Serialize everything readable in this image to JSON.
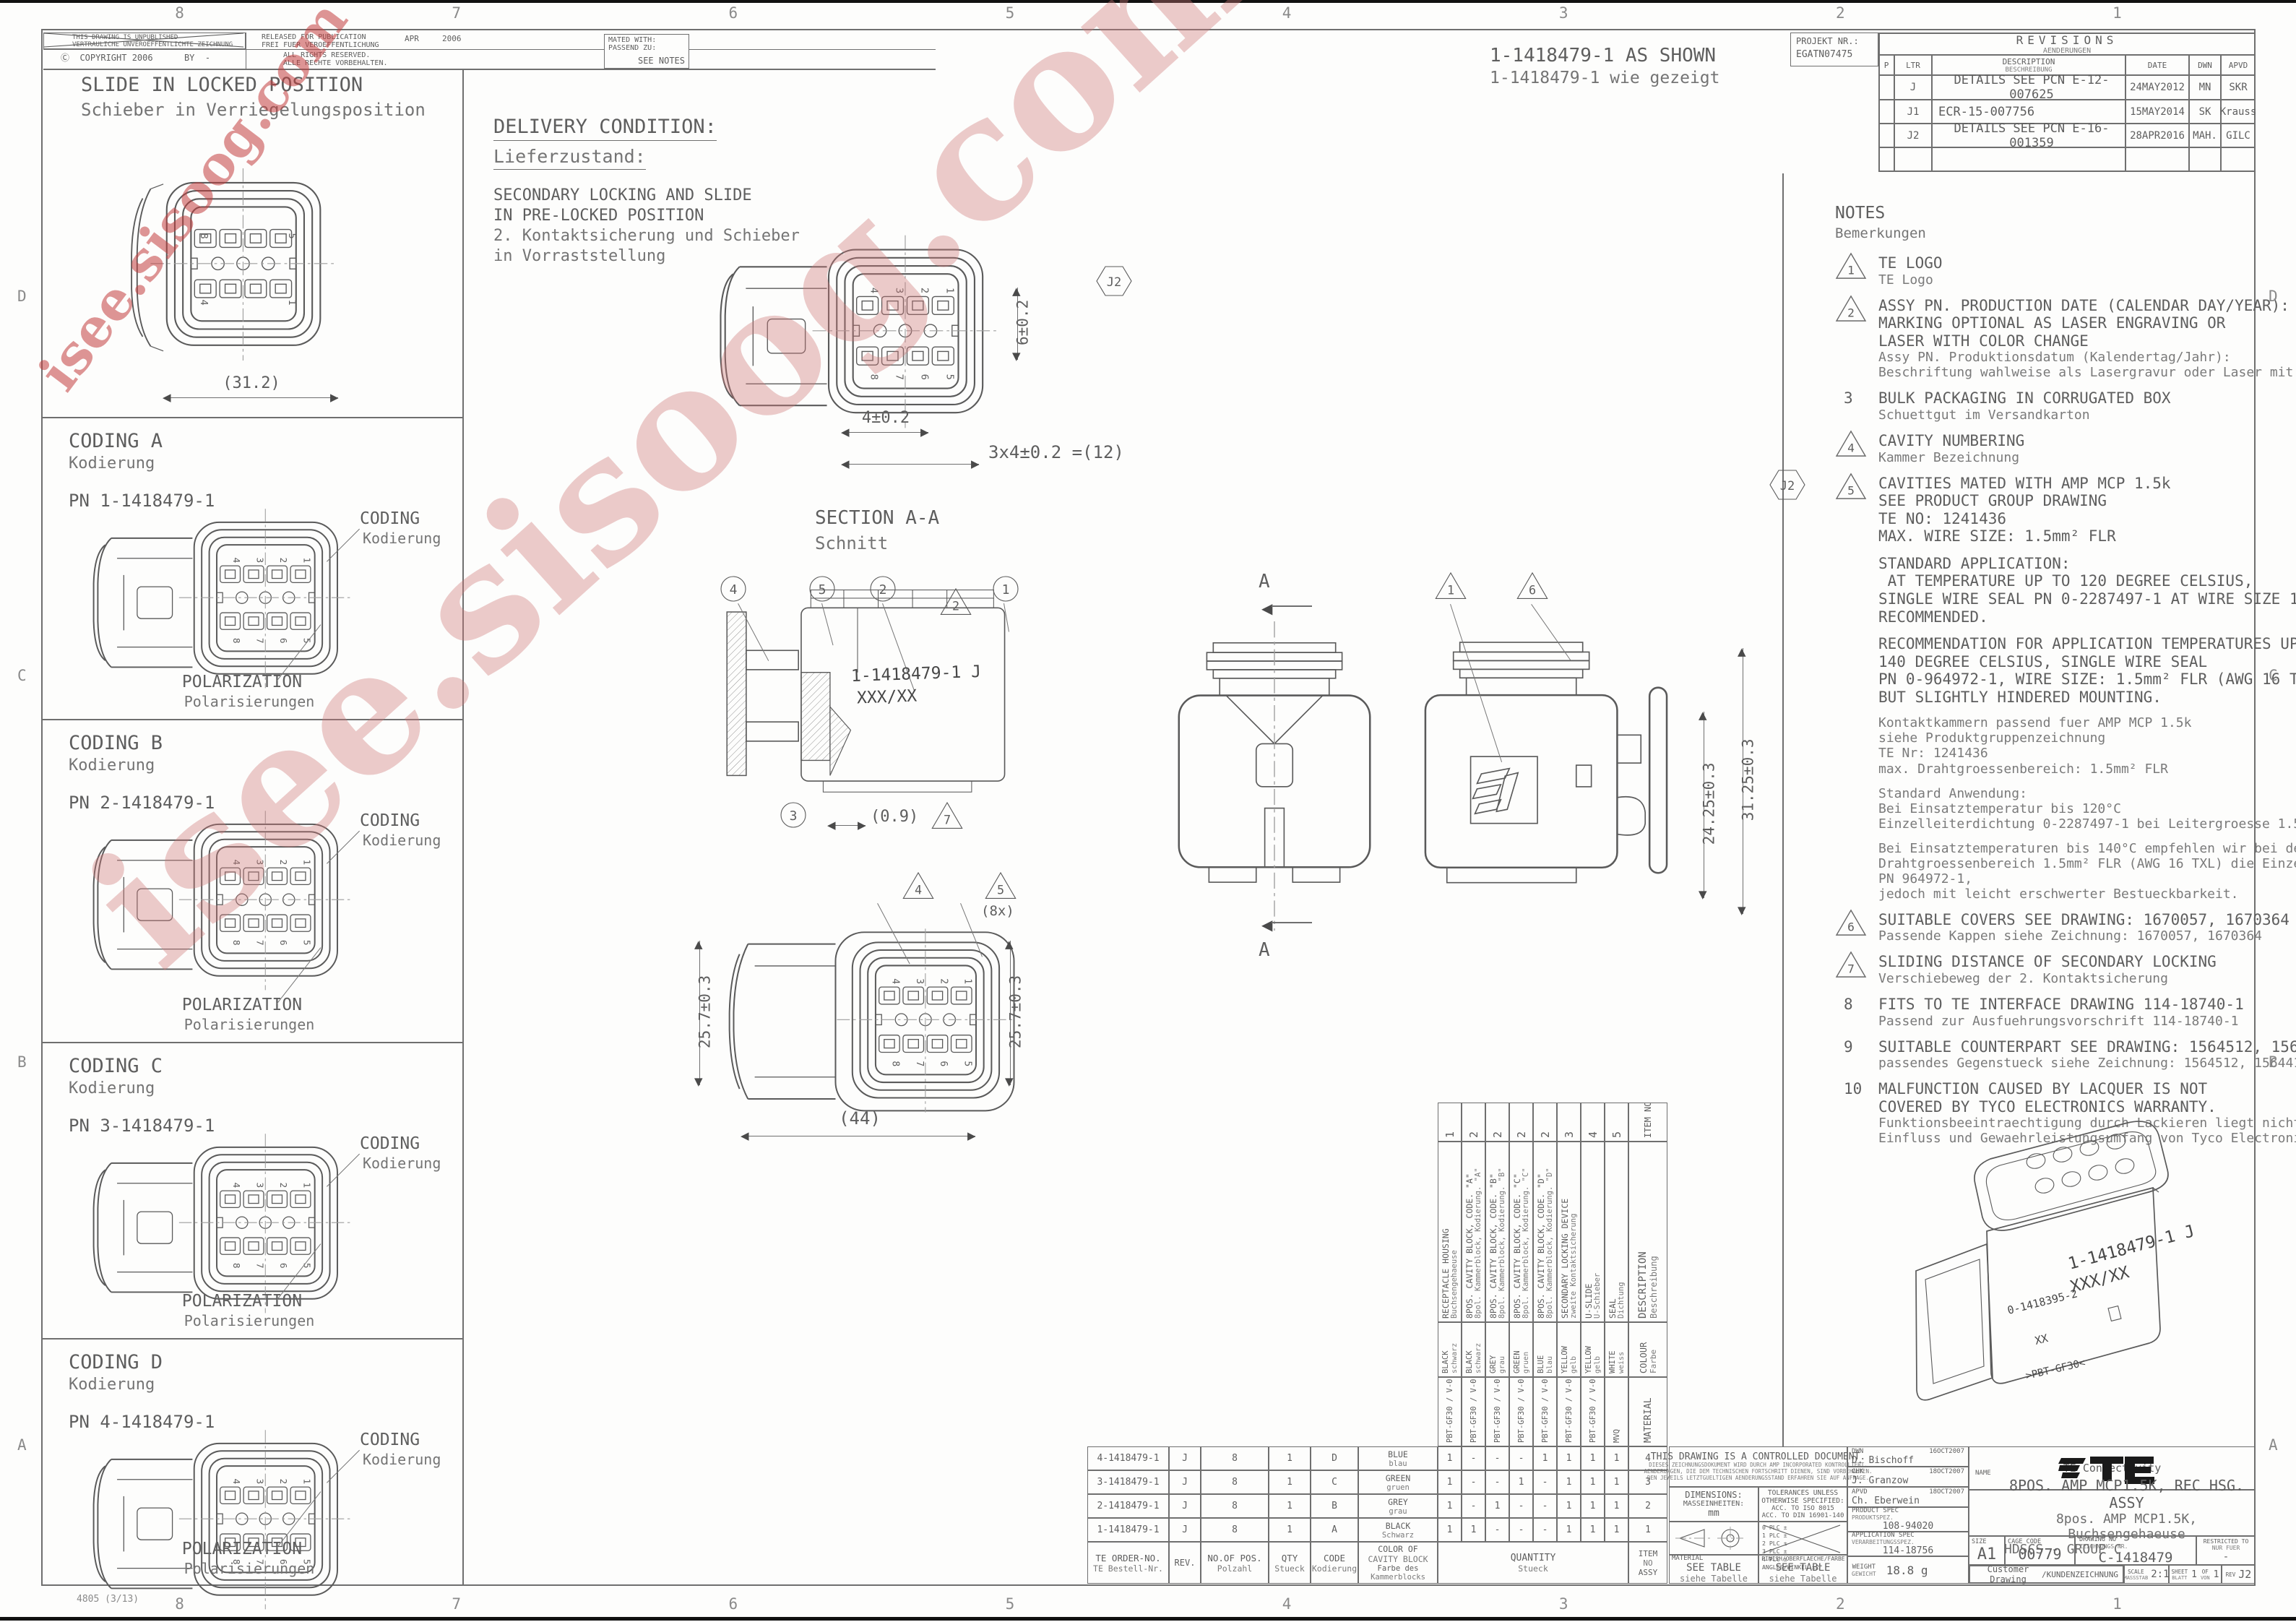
{
  "meta": {
    "accent": "#c75252",
    "line": "#5a5a5a"
  },
  "watermark": {
    "text": "isee.sisoog.com"
  },
  "frame": {
    "zones_h": [
      "8",
      "7",
      "6",
      "5",
      "4",
      "3",
      "2",
      "1"
    ],
    "zones_v": [
      "D",
      "C",
      "B",
      "A"
    ],
    "stamp": "4805 (3/13)"
  },
  "header": {
    "unpublished1": "THIS DRAWING IS UNPUBLISHED",
    "unpublished2": "VERTRAULICHE UNVEROEFFENTLICHTE ZEICHNUNG",
    "copyright": "Ⓒ  COPYRIGHT 2006      BY  -",
    "released1": "RELEASED FOR PUBLICATION",
    "released2": "FREI FUER VEROEFFENTLICHUNG",
    "rel_month": "APR",
    "rel_year": "2006",
    "rights1": "ALL RIGHTS RESERVED.",
    "rights2": "ALLE RECHTE VORBEHALTEN.",
    "mated1": "MATED WITH:",
    "mated2": "PASSEND ZU:",
    "mated3": "SEE NOTES",
    "as_shown1": "1-1418479-1 AS SHOWN",
    "as_shown2": "1-1418479-1 wie gezeigt",
    "projekt1": "PROJEKT NR.:",
    "projekt2": "EGATN07475"
  },
  "revisions": {
    "title": "REVISIONS",
    "subtitle": "AENDERUNGEN",
    "col_p": "P",
    "col_ltr": "LTR",
    "col_desc": "DESCRIPTION",
    "col_desc_de": "BESCHREIBUNG",
    "col_date": "DATE",
    "col_dwn": "DWN",
    "col_apvd": "APVD",
    "rows": [
      {
        "ltr": "J",
        "desc": "DETAILS SEE PCN E-12-007625",
        "date": "24MAY2012",
        "dwn": "MN",
        "apvd": "SKR"
      },
      {
        "ltr": "J1",
        "desc": "ECR-15-007756",
        "date": "15MAY2014",
        "dwn": "SK",
        "apvd": "Krauss"
      },
      {
        "ltr": "J2",
        "desc": "DETAILS SEE PCN E-16-001359",
        "date": "28APR2016",
        "dwn": "MAH.",
        "apvd": "GILC"
      }
    ],
    "rev_flag": "J2"
  },
  "views": {
    "slide": {
      "title": "SLIDE IN LOCKED POSITION",
      "subtitle": "Schieber in Verriegelungsposition",
      "dim": "(31.2)"
    },
    "codings": [
      {
        "title": "CODING A",
        "subtitle": "Kodierung",
        "pn": "PN 1-1418479-1"
      },
      {
        "title": "CODING B",
        "subtitle": "Kodierung",
        "pn": "PN 2-1418479-1"
      },
      {
        "title": "CODING C",
        "subtitle": "Kodierung",
        "pn": "PN 3-1418479-1"
      },
      {
        "title": "CODING D",
        "subtitle": "Kodierung",
        "pn": "PN 4-1418479-1"
      }
    ],
    "coding_callout": "CODING",
    "coding_callout_de": "Kodierung",
    "polarization": "POLARIZATION",
    "polarization_de": "Polarisierungen",
    "delivery": {
      "title": "DELIVERY CONDITION:",
      "subtitle": "Lieferzustand:",
      "l1": "SECONDARY LOCKING AND SLIDE",
      "l2": "IN PRE-LOCKED POSITION",
      "l3": "2. Kontaktsicherung und Schieber",
      "l4": "in Vorraststellung"
    },
    "pins": {
      "top": [
        "4",
        "3",
        "2",
        "1"
      ],
      "bottom": [
        "8",
        "7",
        "6",
        "5"
      ],
      "slide_corners": [
        "8",
        "5",
        "4",
        "1"
      ]
    },
    "front_dims": {
      "v": "6±0.2",
      "h1": "4±0.2",
      "h2": "3x4±0.2 =(12)"
    },
    "section": {
      "title": "SECTION A-A",
      "subtitle": "Schnitt",
      "marking1": "1-1418479-1 J",
      "marking2": "XXX/XX",
      "dim": "(0.9)",
      "balloons": [
        "4",
        "5",
        "2",
        "1",
        "3"
      ],
      "tri_top": "2",
      "tri_dim": "7"
    },
    "arrow_label": "A",
    "side_dims": {
      "d1": "24.25±0.3",
      "d2": "31.25±0.3",
      "tri1": "1",
      "tri6": "6"
    },
    "bottom_dims": {
      "left": "25.7±0.3",
      "right": "25.7±0.3",
      "width": "(44)",
      "tri4": "4",
      "tri5": "5",
      "count": "(8x)"
    },
    "iso": {
      "m1": "1-1418479-1 J",
      "m2": "XXX/XX",
      "m3": "0-1418395-2",
      "m4": "XX",
      "m5": ">PBT-GF30<"
    }
  },
  "notes": {
    "title": "NOTES",
    "subtitle": "Bemerkungen",
    "j2_flag": "J2",
    "items": [
      {
        "marker": "tri",
        "no": "1",
        "en": [
          "TE LOGO"
        ],
        "de": [
          "TE Logo"
        ]
      },
      {
        "marker": "tri",
        "no": "2",
        "en": [
          "ASSY PN. PRODUCTION DATE (CALENDAR DAY/YEAR):",
          "MARKING OPTIONAL AS LASER ENGRAVING OR",
          "LASER WITH COLOR CHANGE"
        ],
        "de": [
          "Assy PN. Produktionsdatum (Kalendertag/Jahr):",
          "Beschriftung wahlweise als Lasergravur oder Laser mit Farbumschlag"
        ]
      },
      {
        "marker": "num",
        "no": "3",
        "en": [
          "BULK PACKAGING IN CORRUGATED BOX"
        ],
        "de": [
          "Schuettgut im Versandkarton"
        ]
      },
      {
        "marker": "tri",
        "no": "4",
        "en": [
          "CAVITY NUMBERING"
        ],
        "de": [
          "Kammer Bezeichnung"
        ]
      },
      {
        "marker": "tri",
        "no": "5",
        "en": [
          "CAVITIES MATED WITH AMP MCP 1.5k",
          "SEE PRODUCT GROUP DRAWING",
          "TE NO: 1241436",
          "MAX. WIRE SIZE: 1.5mm² FLR"
        ],
        "de": []
      },
      {
        "marker": "none",
        "no": "",
        "en": [
          "STANDARD APPLICATION:",
          " AT TEMPERATURE UP TO 120 DEGREE CELSIUS,",
          "SINGLE WIRE SEAL PN 0-2287497-1 AT WIRE SIZE 1.5mm² FLR",
          "RECOMMENDED."
        ],
        "de": []
      },
      {
        "marker": "none",
        "no": "",
        "en": [
          "RECOMMENDATION FOR APPLICATION TEMPERATURES UP TO",
          "140 DEGREE CELSIUS, SINGLE WIRE SEAL",
          "PN 0-964972-1, WIRE SIZE: 1.5mm² FLR (AWG 16 TXL)",
          "BUT SLIGHTLY HINDERED MOUNTING."
        ],
        "de": []
      },
      {
        "marker": "none",
        "no": "",
        "en": [],
        "de": [
          "Kontaktkammern passend fuer AMP MCP 1.5k",
          "siehe Produktgruppenzeichnung",
          "TE Nr: 1241436",
          "max. Drahtgroessenbereich: 1.5mm² FLR"
        ]
      },
      {
        "marker": "none",
        "no": "",
        "en": [],
        "de": [
          "Standard Anwendung:",
          "Bei Einsatztemperatur bis 120°C",
          "Einzelleiterdichtung 0-2287497-1 bei Leitergroesse 1.5mm² FLR empfohlen."
        ]
      },
      {
        "marker": "none",
        "no": "",
        "en": [],
        "de": [
          "Bei Einsatztemperaturen bis 140°C empfehlen wir bei dem",
          "Drahtgroessenbereich 1.5mm² FLR (AWG 16 TXL) die Einzelleiterdichtung",
          "PN 964972-1,",
          "jedoch mit leicht erschwerter Bestueckbarkeit."
        ]
      },
      {
        "marker": "tri",
        "no": "6",
        "en": [
          "SUITABLE COVERS SEE DRAWING: 1670057, 1670364"
        ],
        "de": [
          "Passende Kappen siehe Zeichnung: 1670057, 1670364"
        ]
      },
      {
        "marker": "tri",
        "no": "7",
        "en": [
          "SLIDING DISTANCE OF SECONDARY LOCKING"
        ],
        "de": [
          "Verschiebeweg der 2. Kontaktsicherung"
        ]
      },
      {
        "marker": "num",
        "no": "8",
        "en": [
          "FITS TO TE INTERFACE DRAWING 114-18740-1"
        ],
        "de": [
          "Passend zur Ausfuehrungsvorschrift 114-18740-1"
        ]
      },
      {
        "marker": "num",
        "no": "9",
        "en": [
          "SUITABLE COUNTERPART SEE DRAWING: 1564512, 1564416"
        ],
        "de": [
          "passendes Gegenstueck siehe Zeichnung: 1564512, 1564416"
        ]
      },
      {
        "marker": "num",
        "no": "10",
        "en": [
          "MALFUNCTION CAUSED BY LACQUER IS NOT",
          "COVERED BY TYCO ELECTRONICS WARRANTY."
        ],
        "de": [
          "Funktionsbeeintraechtigung durch Lackieren liegt nicht im",
          "Einfluss und Gewaehrleistungsumfang von Tyco Electronics."
        ]
      }
    ]
  },
  "vtable": {
    "header": {
      "item1": "ITEM",
      "item2": "NO",
      "desc": "DESCRIPTION",
      "desc_de": "Beschreibung",
      "colour": "COLOUR",
      "colour_de": "Farbe",
      "material": "MATERIAL"
    },
    "items": [
      {
        "no": "1",
        "desc": "RECEPTACLE HOUSING",
        "desc_de": "Buchsengehaeuse",
        "colour": "BLACK",
        "colour_de": "schwarz",
        "material": "PBT-GF30 / V-0"
      },
      {
        "no": "2",
        "desc": "8POS. CAVITY BLOCK, CODE. \"A\"",
        "desc_de": "8pol. Kammerblock, Kodierung. \"A\"",
        "colour": "BLACK",
        "colour_de": "schwarz",
        "material": "PBT-GF30 / V-0"
      },
      {
        "no": "2",
        "desc": "8POS. CAVITY BLOCK, CODE. \"B\"",
        "desc_de": "8pol. Kammerblock, Kodierung. \"B\"",
        "colour": "GREY",
        "colour_de": "grau",
        "material": "PBT-GF30 / V-0"
      },
      {
        "no": "2",
        "desc": "8POS. CAVITY BLOCK, CODE. \"C\"",
        "desc_de": "8pol. Kammerblock, Kodierung. \"C\"",
        "colour": "GREEN",
        "colour_de": "gruen",
        "material": "PBT-GF30 / V-0"
      },
      {
        "no": "2",
        "desc": "8POS. CAVITY BLOCK, CODE. \"D\"",
        "desc_de": "8pol. Kammerblock, Kodierung. \"D\"",
        "colour": "BLUE",
        "colour_de": "blau",
        "material": "PBT-GF30 / V-0"
      },
      {
        "no": "3",
        "desc": "SECONDARY LOCKING DEVICE",
        "desc_de": "zweite Kontaktsicherung",
        "colour": "YELLOW",
        "colour_de": "gelb",
        "material": "PBT-GF30 / V-0"
      },
      {
        "no": "4",
        "desc": "U-SLIDE",
        "desc_de": "U-Schieber",
        "colour": "YELLOW",
        "colour_de": "gelb",
        "material": "PBT-GF30 / V-0"
      },
      {
        "no": "5",
        "desc": "SEAL",
        "desc_de": "Dichtung",
        "colour": "WHITE",
        "colour_de": "weiss",
        "material": "MVQ"
      }
    ]
  },
  "table": {
    "h_order1": "TE ORDER-NO.",
    "h_order2": "TE Bestell-Nr.",
    "h_rev": "REV.",
    "h_pos1": "NO.OF POS.",
    "h_pos2": "Polzahl",
    "h_qty1": "QTY",
    "h_qty2": "Stueck",
    "h_code1": "CODE",
    "h_code2": "Kodierung",
    "h_color1": "COLOR OF",
    "h_color2": "CAVITY BLOCK",
    "h_color3": "Farbe des",
    "h_color4": "Kammerblocks",
    "h_quantity1": "QUANTITY",
    "h_quantity2": "Stueck",
    "h_item1": "ITEM",
    "h_item2": "NO",
    "h_item3": "ASSY",
    "rows": [
      {
        "order": "4-1418479-1",
        "rev": "J",
        "pos": "8",
        "qty": "1",
        "code": "D",
        "color": "BLUE",
        "color_de": "blau",
        "q": [
          "1",
          "-",
          "-",
          "-",
          "1",
          "1",
          "1",
          "1"
        ],
        "item": "4"
      },
      {
        "order": "3-1418479-1",
        "rev": "J",
        "pos": "8",
        "qty": "1",
        "code": "C",
        "color": "GREEN",
        "color_de": "gruen",
        "q": [
          "1",
          "-",
          "-",
          "1",
          "-",
          "1",
          "1",
          "1"
        ],
        "item": "3"
      },
      {
        "order": "2-1418479-1",
        "rev": "J",
        "pos": "8",
        "qty": "1",
        "code": "B",
        "color": "GREY",
        "color_de": "grau",
        "q": [
          "1",
          "-",
          "1",
          "-",
          "-",
          "1",
          "1",
          "1"
        ],
        "item": "2"
      },
      {
        "order": "1-1418479-1",
        "rev": "J",
        "pos": "8",
        "qty": "1",
        "code": "A",
        "color": "BLACK",
        "color_de": "Schwarz",
        "q": [
          "1",
          "1",
          "-",
          "-",
          "-",
          "1",
          "1",
          "1"
        ],
        "item": "1"
      }
    ]
  },
  "tblock": {
    "ctrl1": "THIS DRAWING IS A CONTROLLED DOCUMENT.",
    "ctrl_de1": "DIESES ZEICHNUNGSDOKUMENT WIRD DURCH AMP INCORPORATED KONTROLLIERT.",
    "ctrl_de2": "AENDERUNGEN, DIE DEM TECHNISCHEN FORTSCHRITT DIENEN, SIND VORBEHALTEN.",
    "ctrl_de3": "DEN JEWEILS LETZTGUELTIGEN AENDERUNGSSTAND ERFAHREN SIE AUF ANFRAGE.",
    "dim1": "DIMENSIONS:",
    "dim2": "MASSEINHEITEN:",
    "dim3": "mm",
    "tol1": "TOLERANCES UNLESS",
    "tol2": "OTHERWISE SPECIFIED:",
    "tol3": "ACC. TO ISO 8015",
    "tol4": "ACC. TO DIN 16901-140",
    "plc": [
      "0 PLC    ±",
      "1 PLC    ±",
      "2 PLC    ±",
      "3 PLC    ±",
      "4 PLC    ±",
      "ANGLES/WINKEL   ±2°"
    ],
    "mat_l": "MATERIAL",
    "mat_v1": "SEE TABLE",
    "mat_v2": "siehe Tabelle",
    "fin_l": "FINISH/OBERFLAECHE/FARBE",
    "fin_v1": "SEE TABLE",
    "fin_v2": "siehe Tabelle",
    "dwn_l": "DWN",
    "dwn_n": "D. Bischoff",
    "dwn_d": "16OCT2007",
    "chk_l": "CHK",
    "chk_n": "J. Granzow",
    "chk_d": "18OCT2007",
    "apvd_l": "APVD",
    "apvd_n": "Ch. Eberwein",
    "apvd_d": "18OCT2007",
    "prod_l1": "PRODUCT SPEC",
    "prod_l2": "PRODUKTSPEZ.",
    "prod_v": "108-94020",
    "appl_l1": "APPLICATION SPEC",
    "appl_l2": "VERARBEITUNGSSPEZ.",
    "appl_v": "114-18756",
    "wt_l1": "WEIGHT",
    "wt_l2": "GEWICHT",
    "wt_v": "18.8 g",
    "logo_te": "TE",
    "brand": "TE Connectivity",
    "name_l": "NAME",
    "name1": "8POS. AMP MCP1.5K, REC HSG. ASSY",
    "name2": "8pos. AMP MCP1.5K, Buchsengehaeuse",
    "name3": "HDSCS - GROUP C",
    "size_l": "SIZE",
    "size_v": "A1",
    "cage_l": "CAGE CODE",
    "cage_v": "00779",
    "dno_l1": "DRAWING NO",
    "dno_l2": "ZEICHNUNGS-NR.",
    "dno_v": "C-1418479",
    "restr_l1": "RESTRICTED TO",
    "restr_l2": "NUR FUER",
    "restr_v": "-",
    "cust1": "Customer Drawing",
    "cust2": "/KUNDENZEICHNUNG",
    "scale_l1": "SCALE",
    "scale_l2": "MASSSTAB",
    "scale_v": "2:1",
    "sheet_l1": "SHEET",
    "sheet_l2": "BLATT",
    "sheet_v": "1",
    "of_l1": "OF",
    "of_l2": "VON",
    "of_v": "1",
    "rev_l": "REV",
    "rev_v": "J2"
  }
}
